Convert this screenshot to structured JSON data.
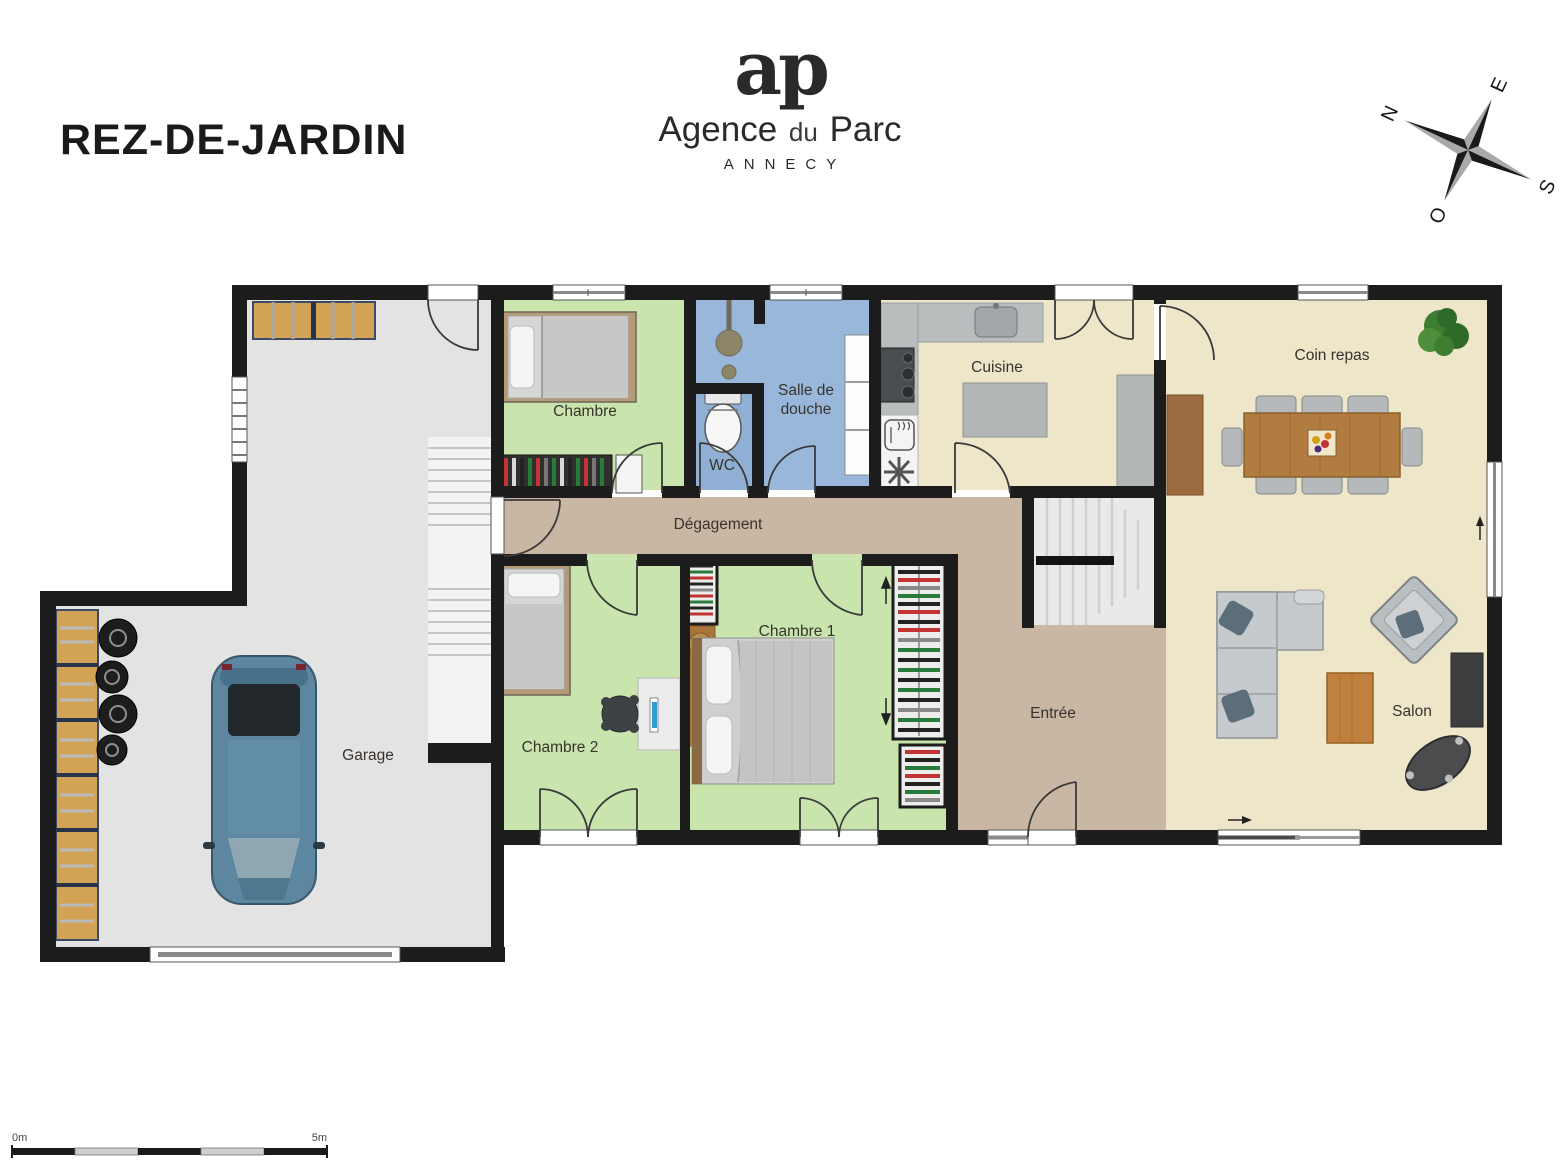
{
  "title": "REZ-DE-JARDIN",
  "logo": {
    "monogram": "ap",
    "name_part1": "Agence",
    "name_part2": "du",
    "name_part3": "Parc",
    "city": "ANNECY"
  },
  "compass": {
    "north": "N",
    "east": "E",
    "south": "S",
    "west": "O"
  },
  "rooms": {
    "chambre": "Chambre",
    "wc": "WC",
    "salle_de_douche_l1": "Salle de",
    "salle_de_douche_l2": "douche",
    "cuisine": "Cuisine",
    "coin_repas": "Coin repas",
    "degagement": "Dégagement",
    "chambre1": "Chambre 1",
    "chambre2": "Chambre 2",
    "entree": "Entrée",
    "salon": "Salon",
    "garage": "Garage"
  },
  "scale": {
    "start": "0m",
    "end": "5m"
  },
  "colors": {
    "wall": "#1c1c1c",
    "bedroom_green": "#c9e5ad",
    "bath_blue": "#98b7da",
    "living_cream": "#eee6c9",
    "hall_taupe": "#c9b6a3",
    "garage_grey": "#e3e3e4",
    "wood_shelf": "#d2a255",
    "table_wood": "#b07c40"
  }
}
